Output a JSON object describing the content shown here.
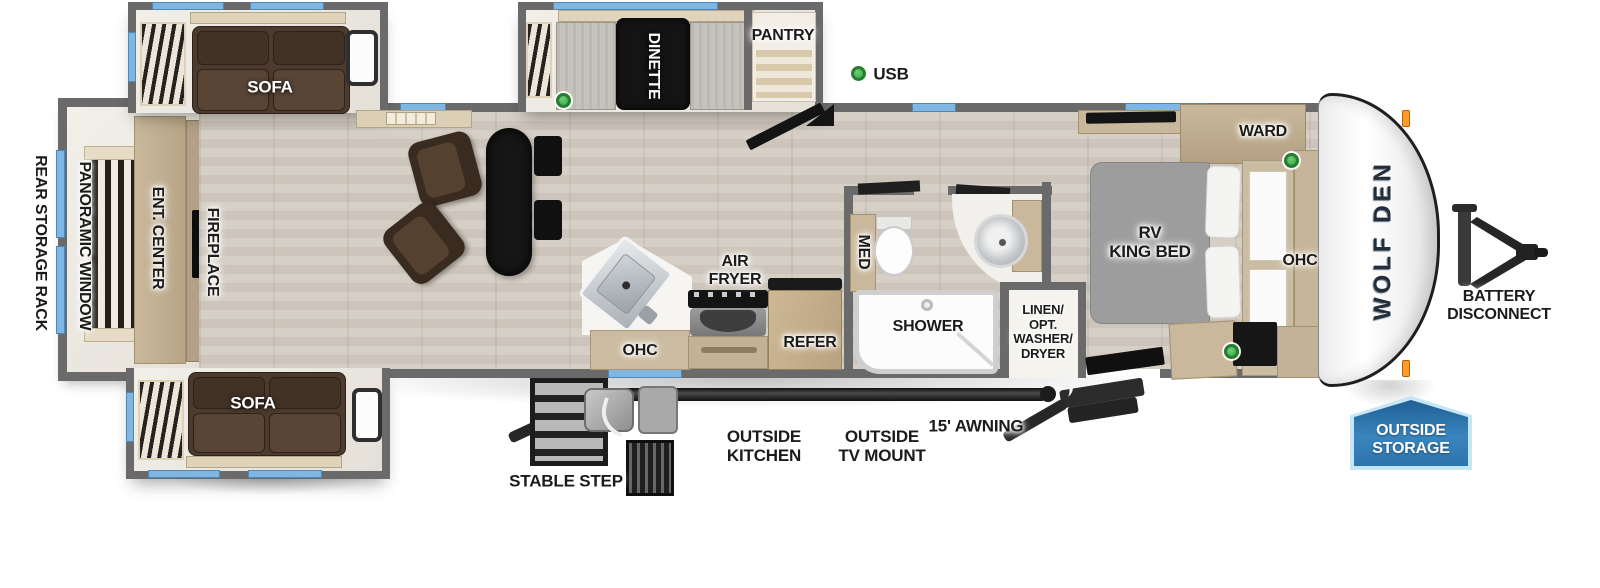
{
  "title": "Wolf Den travel trailer floor plan",
  "brand_logo": "WOLF DEN",
  "labels": {
    "rear_storage_rack": "REAR STORAGE RACK",
    "panoramic_window": "PANORAMIC WINDOW",
    "ent_center": "ENT. CENTER",
    "fireplace": "FIREPLACE",
    "sofa_top": "SOFA",
    "sofa_bottom": "SOFA",
    "dinette": "DINETTE",
    "pantry": "PANTRY",
    "usb": "USB",
    "air_fryer": "AIR\nFRYER",
    "ohc_kitchen": "OHC",
    "refer": "REFER",
    "med": "MED",
    "shower": "SHOWER",
    "linen": "LINEN/\nOPT.\nWASHER/\nDRYER",
    "rv_king_bed": "RV\nKING BED",
    "ward": "WARD",
    "ohc_bedroom": "OHC",
    "battery_disconnect": "BATTERY\nDISCONNECT",
    "outside_storage": "OUTSIDE\nSTORAGE",
    "stable_step": "STABLE STEP",
    "outside_kitchen": "OUTSIDE\nKITCHEN",
    "outside_tv_mount": "OUTSIDE\nTV MOUNT",
    "awning": "15' AWNING"
  },
  "colors": {
    "wall_gray": "#6a6a6a",
    "window_blue": "#7fb7e2",
    "usb_dot_green": "#35a542",
    "badge_blue": "#2d74ad",
    "sofa_brown": "#4c3a2c",
    "cabinet_tan": "#c9b89c",
    "mattress_gray": "#9d9d9d"
  }
}
